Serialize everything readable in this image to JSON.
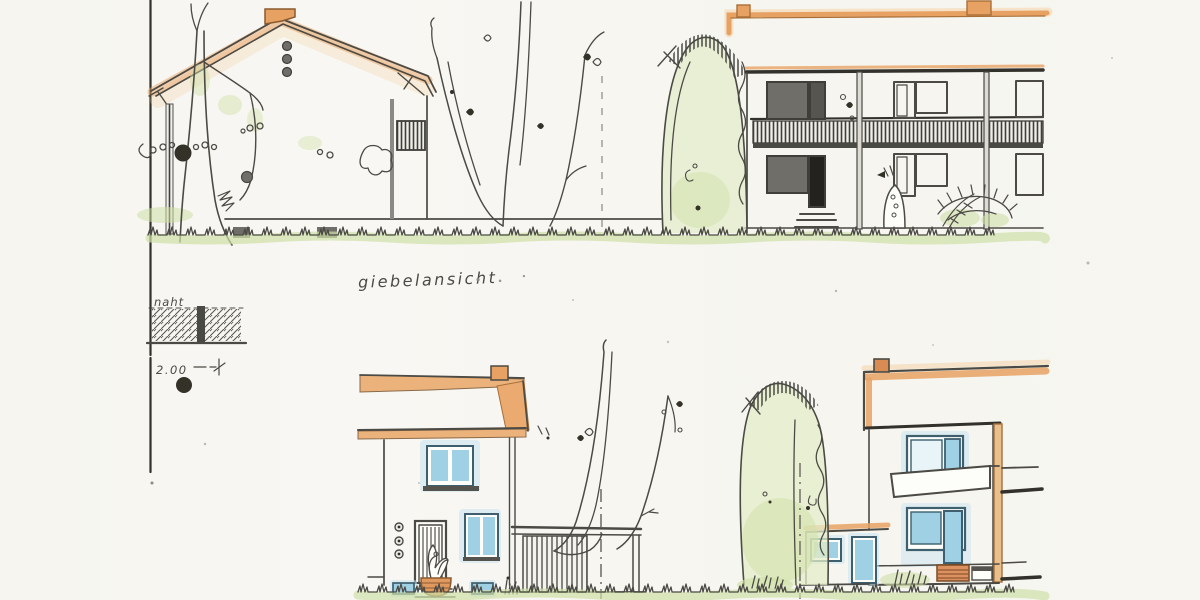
{
  "drawing": {
    "gable_view_label": "giebelansicht",
    "seam_detail_label": "naht",
    "seam_dimension": "2.00"
  },
  "palette": {
    "paper": "#f7f6f1",
    "ink": "#4b4a44",
    "ink-dark": "#32312c",
    "gray-fill": "#6f6e68",
    "dark-fill": "#343129",
    "marker-orange": "#e7a263",
    "marker-orange-light": "#f4cf9f",
    "marker-orange-deep": "#d88c54",
    "orange-outline": "#a96f38",
    "post-tan": "#e9c08c",
    "marker-blue": "#9fd0e4",
    "marker-blue-light": "#c9e4f0",
    "window-frame": "#3d5f6e",
    "marker-green": "#cfe0a6",
    "green-soft": "#e3ecc8"
  }
}
